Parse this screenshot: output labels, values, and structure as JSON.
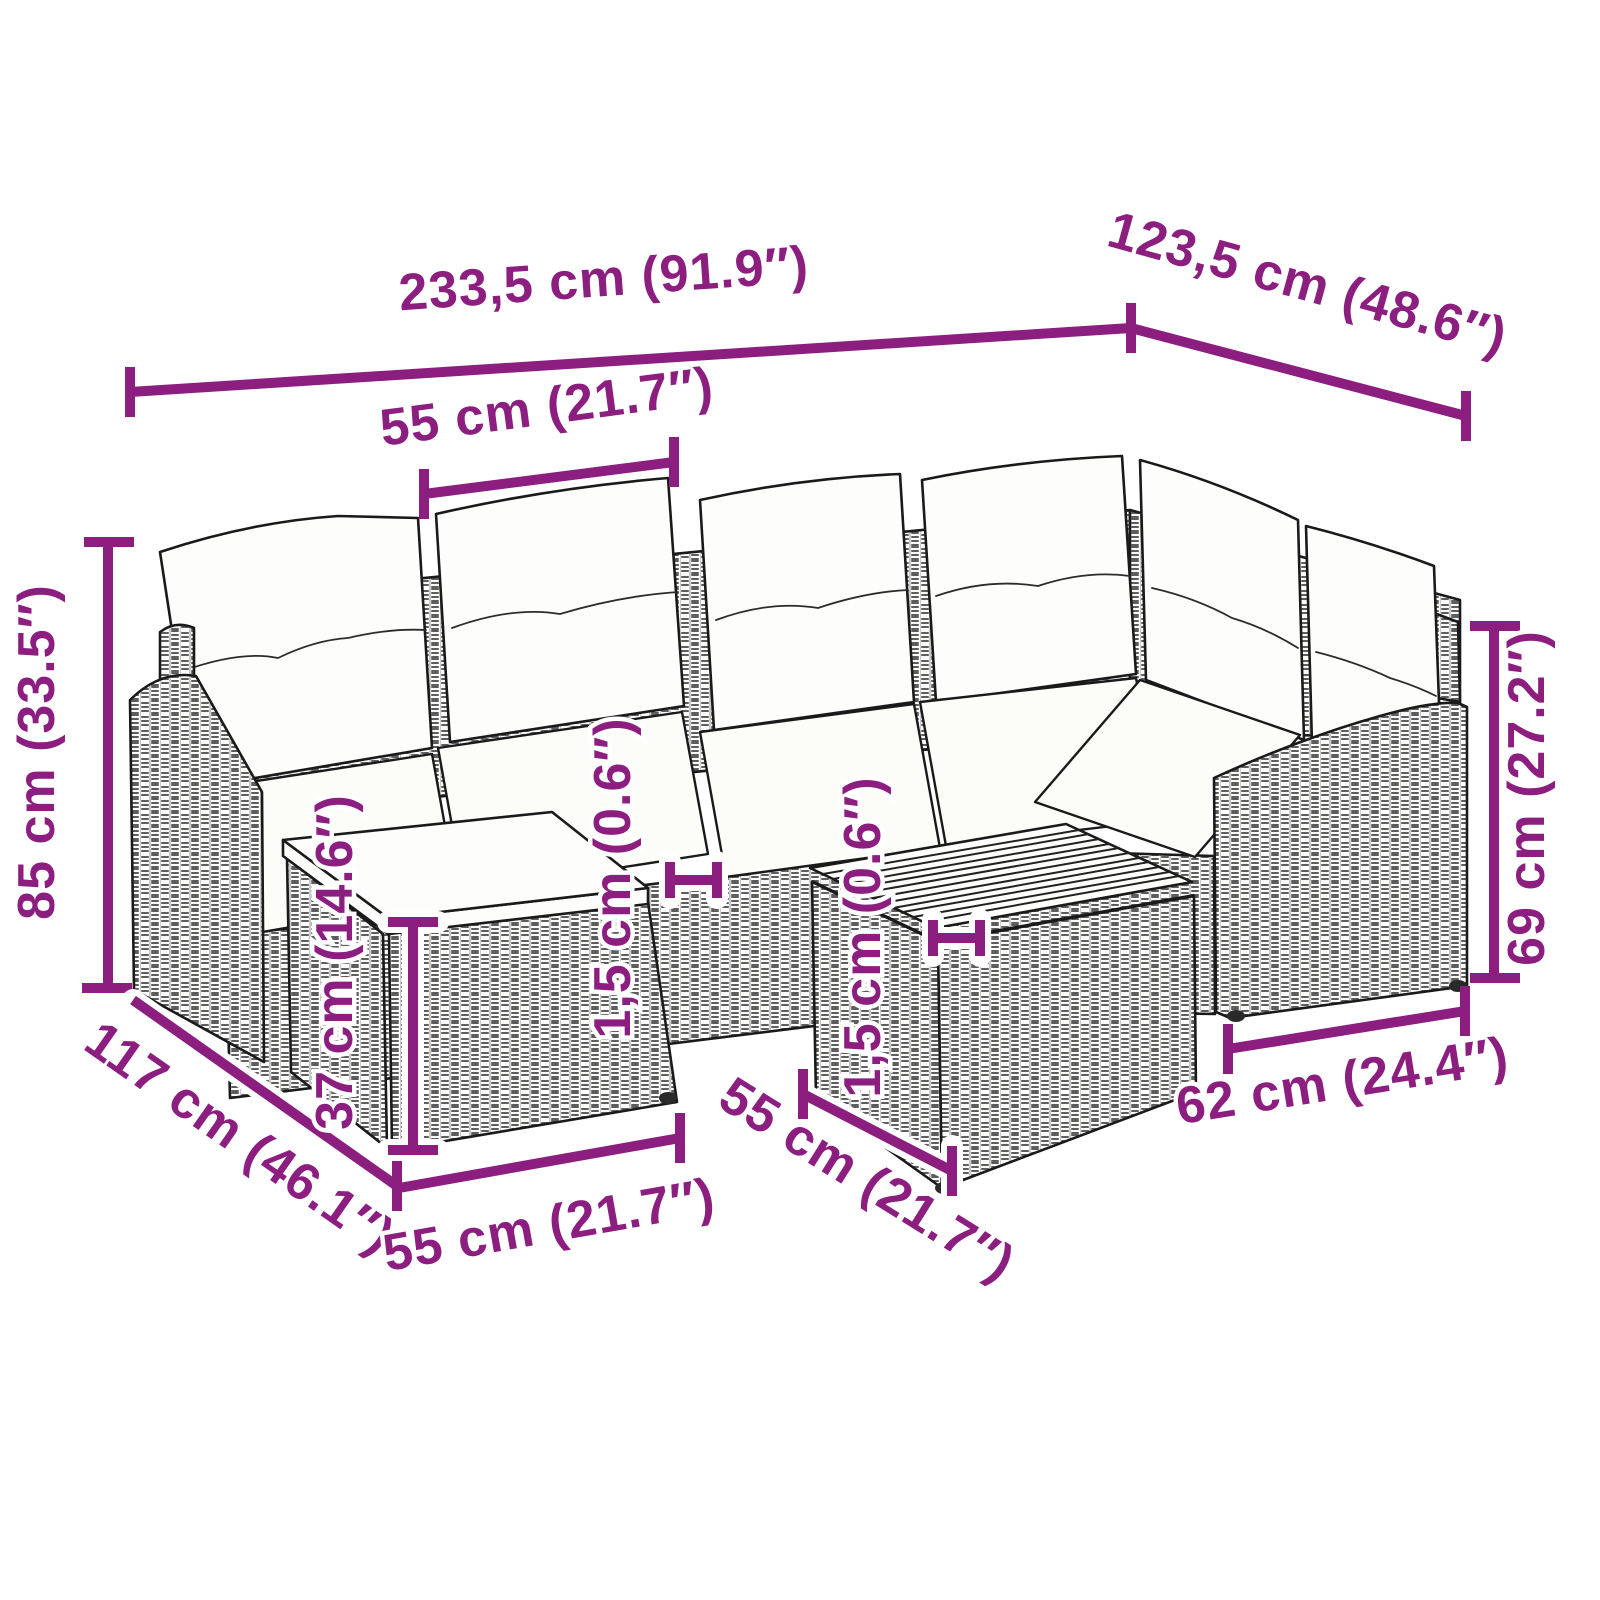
{
  "colors": {
    "accent": "#8C1E80",
    "line_art": "#1a1a1a",
    "background": "#ffffff"
  },
  "dims": {
    "overall_width": {
      "label": "233,5 cm (91.9″)"
    },
    "overall_depth": {
      "label": "123,5 cm (48.6″)"
    },
    "seat_width": {
      "label": "55 cm (21.7″)"
    },
    "overall_height": {
      "label": "85 cm (33.5″)"
    },
    "armrest_height": {
      "label": "69 cm (27.2″)"
    },
    "sofa_depth": {
      "label": "117 cm (46.1″)"
    },
    "footstool_width": {
      "label": "55 cm (21.7″)"
    },
    "table_width": {
      "label": "55 cm (21.7″)"
    },
    "table_depth": {
      "label": "62 cm (24.4″)"
    },
    "footstool_height": {
      "label": "37 cm (14.6″)"
    },
    "seat_edge_thickness": {
      "label": "1,5 cm (0.6″)"
    },
    "tabletop_thickness": {
      "label": "1,5 cm (0.6″)"
    }
  }
}
